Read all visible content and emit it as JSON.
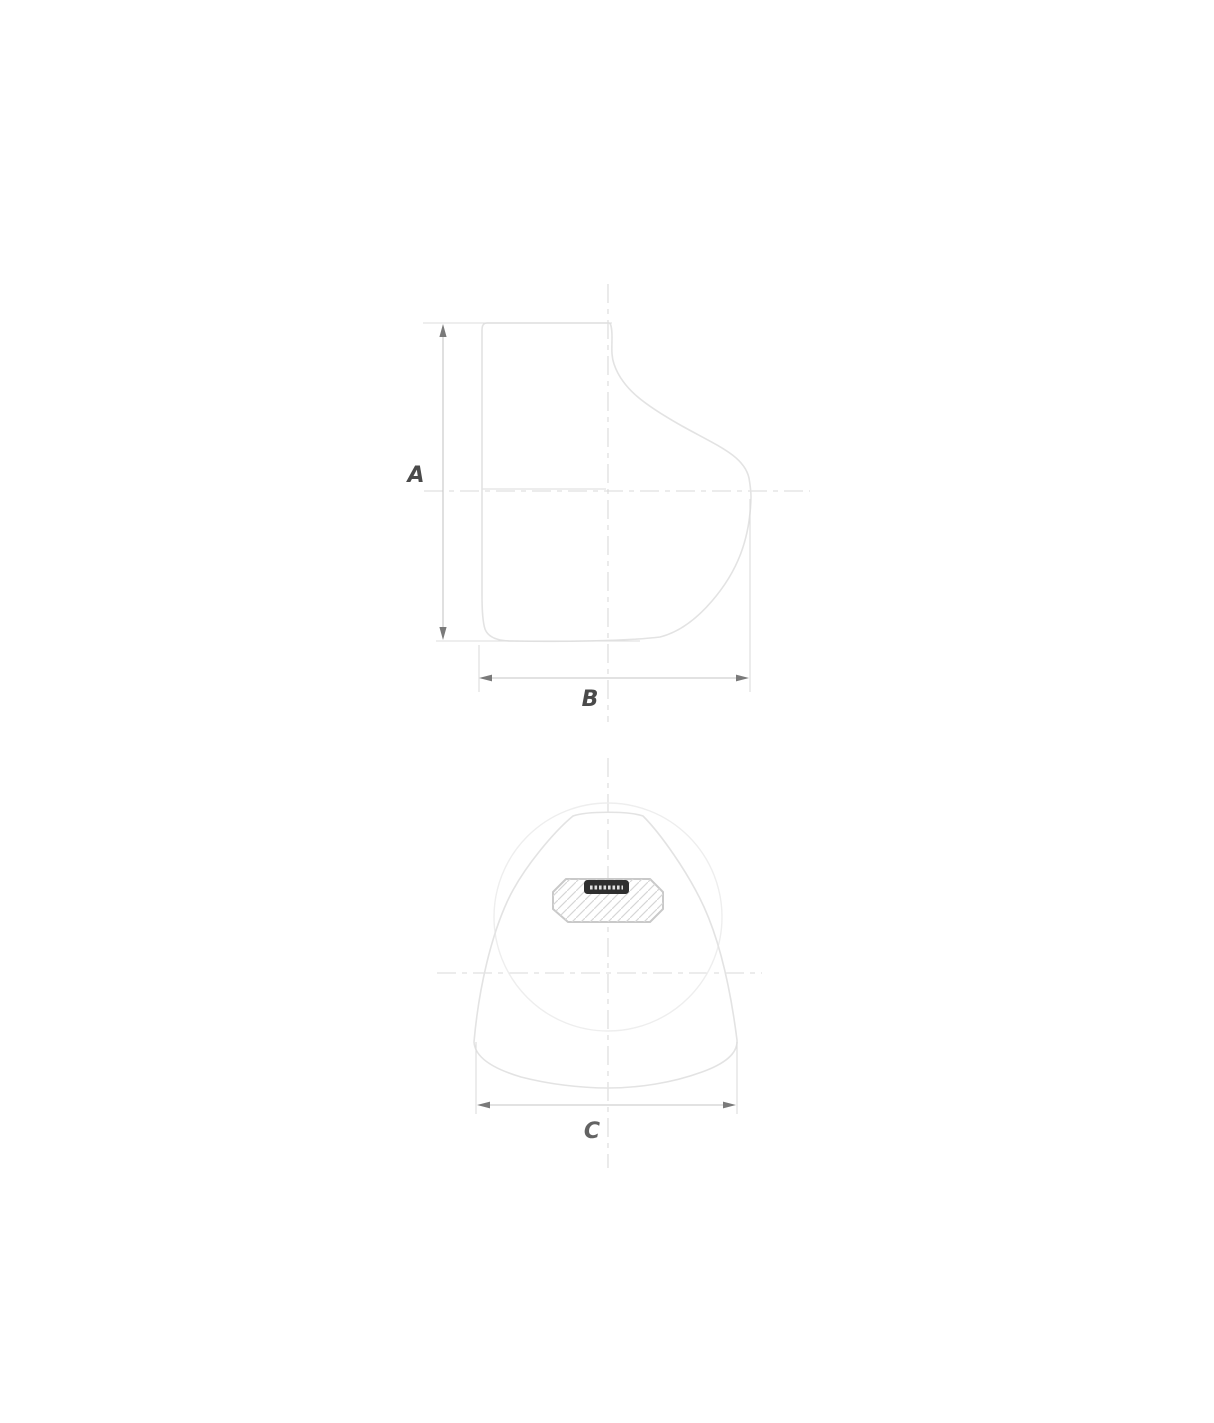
{
  "page": {
    "background_color": "#ffffff"
  },
  "drawing": {
    "kind": "two-view-dimension-drawing",
    "subject": "winch-cover",
    "colors": {
      "outline": "#e3e3e3",
      "faint_outline": "#eeeeee",
      "centerline": "#dadada",
      "extension_line": "#dcdcdc",
      "dimension_line": "#c6c6c6",
      "arrow": "#7a7a7a",
      "label_text": "#4a4a4a",
      "brand_plate_fill": "#2f2f2f",
      "hatch_line": "#d6d6d6"
    },
    "side_view": {
      "dimensions": {
        "height": {
          "label": "A"
        },
        "width": {
          "label": "B"
        }
      }
    },
    "front_view": {
      "dimensions": {
        "width": {
          "label": "C"
        }
      }
    }
  }
}
